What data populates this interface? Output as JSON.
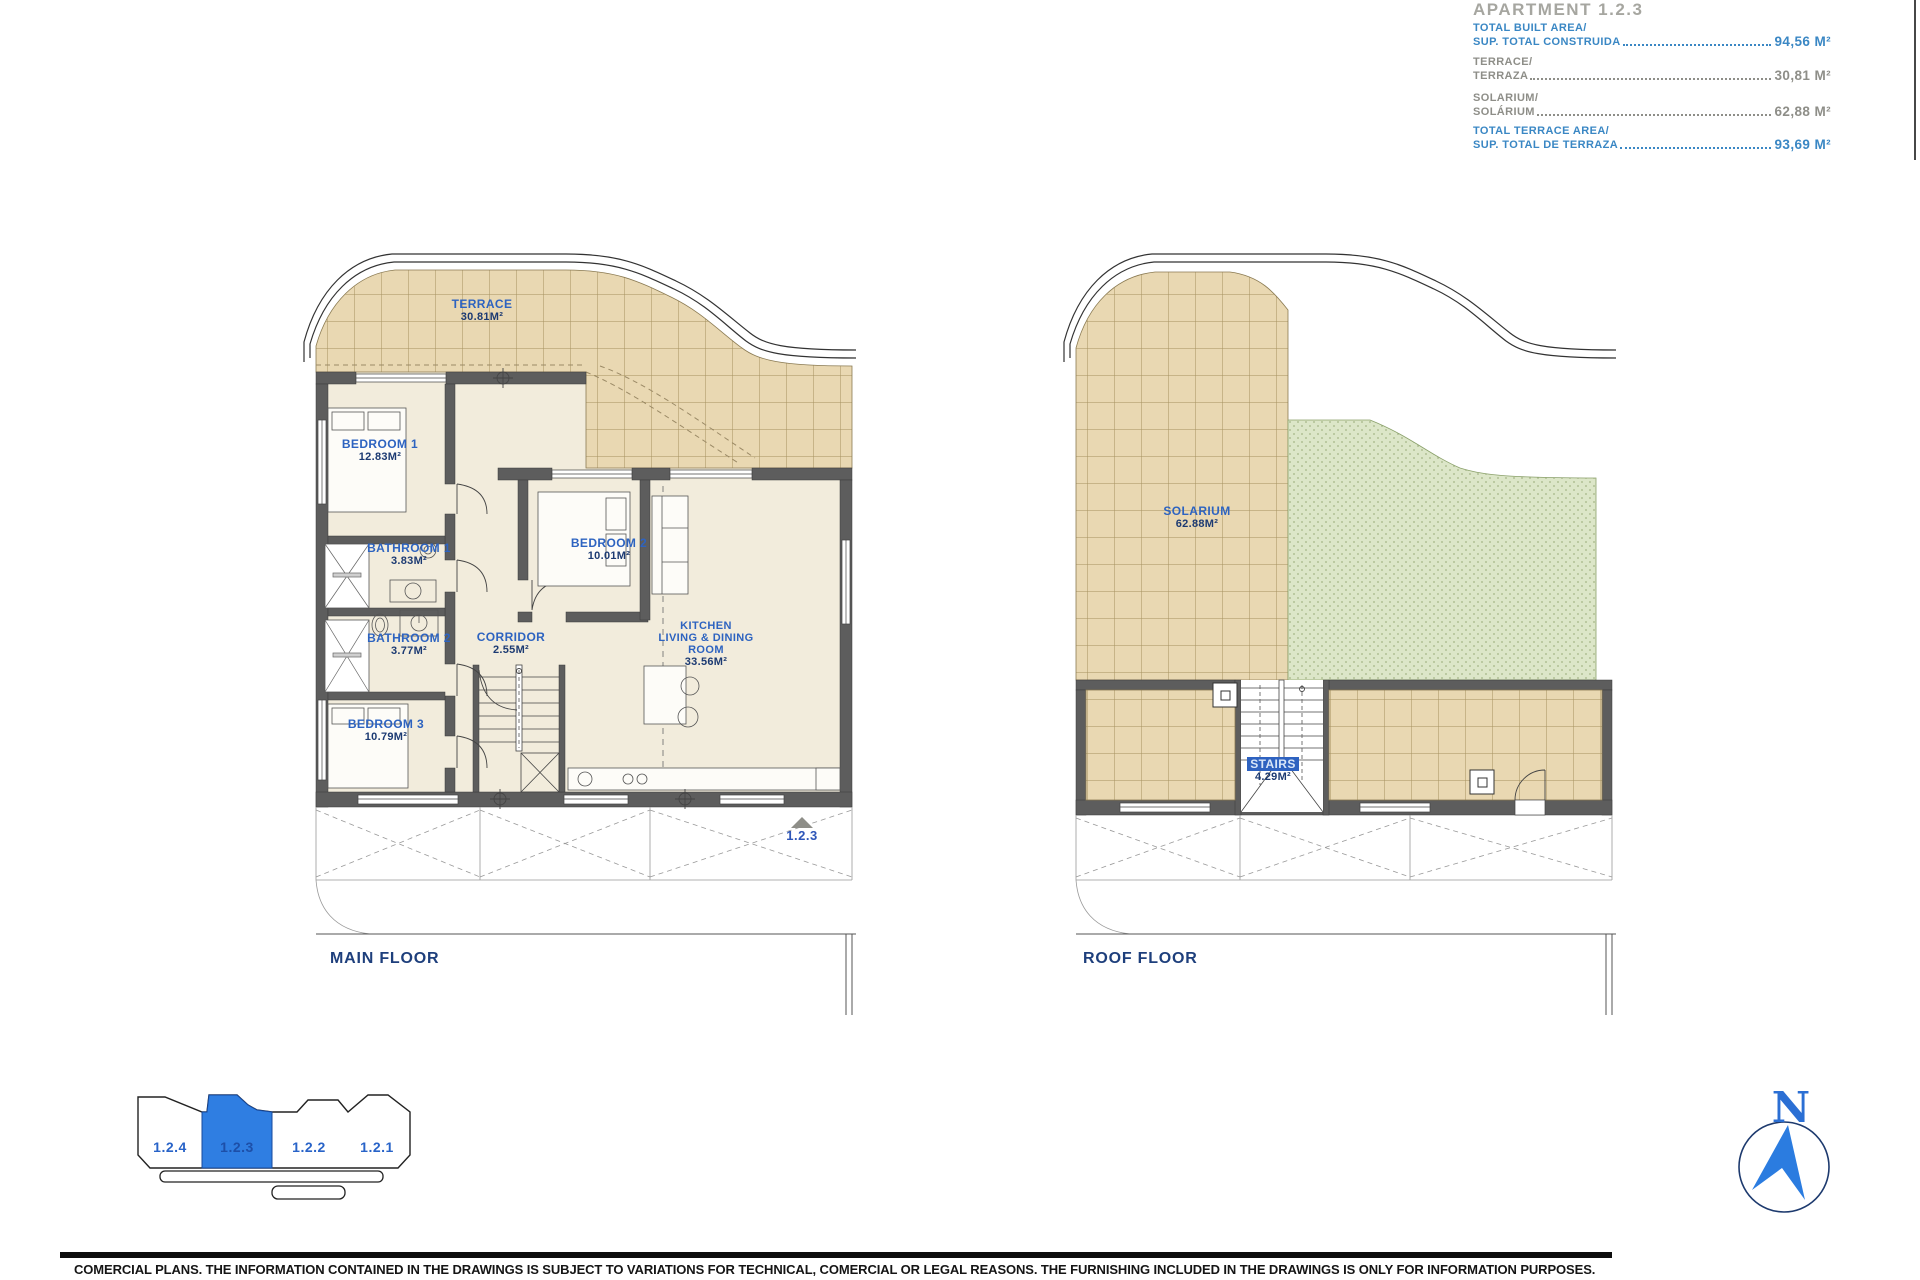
{
  "info_panel": {
    "title": "APARTMENT 1.2.3",
    "rows": [
      {
        "line1": "TOTAL BUILT AREA/",
        "line2": "SUP. TOTAL CONSTRUIDA",
        "value": "94,56 M²"
      },
      {
        "line1": "TERRACE/",
        "line2": "TERRAZA",
        "value": "30,81 M²"
      },
      {
        "line1": "SOLARIUM/",
        "line2": "SOLÁRIUM",
        "value": "62,88 M²"
      },
      {
        "line1": "TOTAL TERRACE AREA/",
        "line2": "SUP. TOTAL DE TERRAZA",
        "value": "93,69 M²"
      }
    ]
  },
  "main_floor": {
    "caption": "MAIN FLOOR",
    "entrance_unit": "1.2.3",
    "rooms": {
      "terrace": {
        "name": "TERRACE",
        "area": "30.81M²"
      },
      "bedroom1": {
        "name": "BEDROOM 1",
        "area": "12.83M²"
      },
      "bathroom1": {
        "name": "BATHROOM 1",
        "area": "3.83M²"
      },
      "bathroom2": {
        "name": "BATHROOM 2",
        "area": "3.77M²"
      },
      "bedroom2": {
        "name": "BEDROOM 2",
        "area": "10.01M²"
      },
      "bedroom3": {
        "name": "BEDROOM 3",
        "area": "10.79M²"
      },
      "corridor": {
        "name": "CORRIDOR",
        "area": "2.55M²"
      },
      "kitchen": {
        "line1": "KITCHEN",
        "line2": "LIVING & DINING",
        "line3": "ROOM",
        "area": "33.56M²"
      }
    }
  },
  "roof_floor": {
    "caption": "ROOF FLOOR",
    "rooms": {
      "solarium": {
        "name": "SOLARIUM",
        "area": "62.88M²"
      },
      "stairs": {
        "name": "STAIRS",
        "area": "4.29M²"
      }
    }
  },
  "key_plan": {
    "units": [
      {
        "label": "1.2.4"
      },
      {
        "label": "1.2.3"
      },
      {
        "label": "1.2.2"
      },
      {
        "label": "1.2.1"
      }
    ],
    "selected": "1.2.3"
  },
  "compass": {
    "north_label": "N"
  },
  "footer": {
    "disclaimer": "COMERCIAL PLANS. THE INFORMATION CONTAINED IN THE DRAWINGS IS SUBJECT TO VARIATIONS FOR TECHNICAL, COMERCIAL OR LEGAL REASONS. THE FURNISHING INCLUDED IN THE DRAWINGS IS ONLY FOR INFORMATION PURPOSES."
  },
  "colors": {
    "room_label_blue": "#2d63c0",
    "area_navy": "#1c3a72",
    "info_blue": "#3a87c4",
    "info_gray": "#8e8e88",
    "tile_tan": "#e9d8b2",
    "solarium_green": "#d9e5c4",
    "unit_highlight": "#2f7ee2"
  }
}
